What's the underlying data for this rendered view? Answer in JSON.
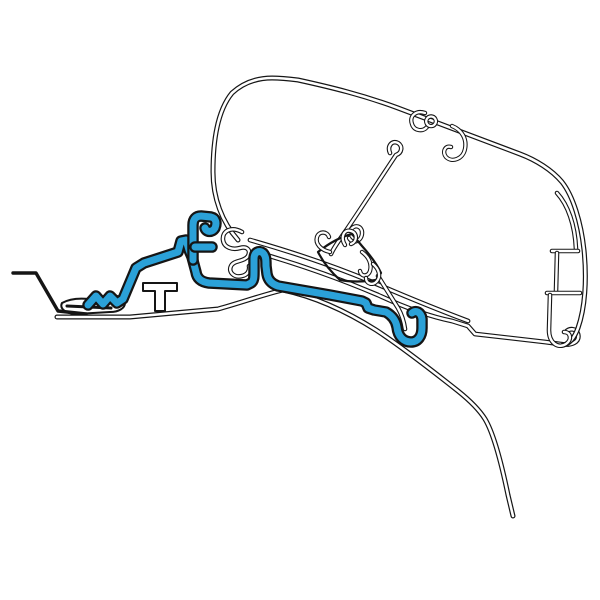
{
  "canvas": {
    "width": 600,
    "height": 600,
    "background": "#ffffff"
  },
  "colors": {
    "line": "#151515",
    "core": "#ffffff",
    "highlight": "#2ba1d8"
  },
  "drawing": {
    "viewbox": "0 0 600 600",
    "parts": [
      {
        "name": "van-gutter-edge",
        "type": "line",
        "outer": 3.4,
        "d": "M 13,273 L 36,273 L 58,311 L 86,314"
      },
      {
        "name": "van-roof-contour",
        "type": "tube",
        "outer": 5,
        "inner": 2.6,
        "d": "M 57,317 L 130,317 L 218,309 C 240,303 262,295 283,290 C 316,297 346,311 376,330 C 402,347 434,372 458,391 C 473,403 480,411 485,419 C 494,434 502,466 508,495 L 513,516"
      },
      {
        "name": "gutter-pad",
        "type": "fill",
        "outer": 2,
        "d": "M 62,303 C 69,299 79,298 89,299 L 110,296 C 119,295 125,298 125,303 C 125,308 119,312 110,312 L 76,314 C 67,314 59,309 62,303 Z"
      },
      {
        "name": "gutter-pad-edge",
        "type": "line",
        "outer": 3,
        "d": "M 67,306 L 111,308"
      },
      {
        "name": "t-bracket",
        "type": "fill",
        "outer": 2,
        "d": "M 143,283 L 177,283 L 177,291 L 165,291 L 165,311 L 155,311 L 155,291 L 143,291 Z"
      },
      {
        "name": "case-rail",
        "type": "tube",
        "outer": 4.8,
        "inner": 2.5,
        "d": "M 256,252 C 298,264 338,278 378,295 C 408,309 432,317 452,321 L 468,326 L 475,334 L 545,342 L 560,344 C 572,346 580,342 578,334 C 576,328 569,328 566,332"
      },
      {
        "name": "case-outline",
        "type": "tube",
        "outer": 5,
        "inner": 2.6,
        "d": "M 238,240 C 222,222 213,198 213,172 C 213,140 218,110 232,93 C 244,82 258,78 272,78 C 282,78 290,79 298,80 C 330,87 363,95 398,108 L 520,154 C 536,160 552,170 562,182 C 573,196 581,222 584,250 C 587,280 585,308 578,328 C 574,339 569,344 563,345"
      },
      {
        "name": "case-bottom-edge",
        "type": "tube",
        "outer": 4.8,
        "inner": 2.5,
        "d": "M 250,240 C 292,252 334,266 372,282 C 402,295 436,309 468,321"
      },
      {
        "name": "case-left-hooks",
        "type": "tube",
        "outer": 4.6,
        "inner": 2.4,
        "d": "M 242,232 C 231,226 222,231 223,240 C 224,248 233,250 240,248 C 247,246 251,250 248,256 C 244,262 234,260 231,266 C 228,272 234,278 242,276 C 247,275 250,271 249,266"
      },
      {
        "name": "rib-top",
        "type": "tube",
        "outer": 4.6,
        "inner": 2.4,
        "d": "M 557,193 C 568,205 575,225 576,249"
      },
      {
        "name": "rib-bar-upper",
        "type": "tube",
        "outer": 4.6,
        "inner": 2.4,
        "d": "M 552,251 L 578,251"
      },
      {
        "name": "rib-wall-upper",
        "type": "tube",
        "outer": 4.6,
        "inner": 2.4,
        "d": "M 557,253 L 556,291"
      },
      {
        "name": "rib-bar-lower",
        "type": "tube",
        "outer": 4.6,
        "inner": 2.4,
        "d": "M 547,293 L 580,293"
      },
      {
        "name": "rib-wall-lower",
        "type": "tube",
        "outer": 4.6,
        "inner": 2.4,
        "d": "M 550,295 L 549,330 C 549,343 558,349 566,344 C 572,340 571,332 564,332"
      },
      {
        "name": "top-hook-small",
        "type": "tube",
        "outer": 4.4,
        "inner": 2.3,
        "d": "M 425,113 C 416,110 409,116 412,124 C 414,131 423,132 427,127"
      },
      {
        "name": "top-hook-ring",
        "type": "tube",
        "outer": 4.4,
        "inner": 2.3,
        "d": "M 431,116.5 a 4.8,4.8 0 1 0 0.1,0"
      },
      {
        "name": "top-hook-large",
        "type": "tube",
        "outer": 4.4,
        "inner": 2.3,
        "d": "M 452,126 C 462,130 467,139 465,149 C 463,159 452,163 446,157 C 442,152 445,145 451,147"
      },
      {
        "name": "inner-strut",
        "type": "tube",
        "outer": 4.6,
        "inner": 2.4,
        "d": "M 390,153 C 387,146 392,140 398,143 C 403,146 402,153 396,155 C 380,179 362,207 347,229 C 340,239 334,247 331,254"
      },
      {
        "name": "inner-strut-hook",
        "type": "tube",
        "outer": 4.4,
        "inner": 2.3,
        "d": "M 350,231 C 354,223 363,226 362,234 C 361,242 352,244 349,238"
      },
      {
        "name": "rafter-bracket-leg",
        "type": "tube",
        "outer": 4.6,
        "inner": 2.4,
        "d": "M 378,276 L 398,308 C 402,315 404,322 405,329"
      },
      {
        "name": "rafter-bracket-body",
        "type": "fill",
        "outer": 2.2,
        "d": "M 318,252 C 328,244 340,237 352,234 L 362,246 C 370,255 377,264 381,273 L 376,280 C 364,282 350,282 340,280 C 331,272 323,262 318,252 Z"
      },
      {
        "name": "rafter-bracket-fork-left",
        "type": "tube",
        "outer": 4.4,
        "inner": 2.3,
        "d": "M 330,252 C 321,250 315,244 317,237 C 319,231 327,231 329,237"
      },
      {
        "name": "rafter-bracket-fork-right",
        "type": "tube",
        "outer": 4.4,
        "inner": 2.3,
        "d": "M 345,245 C 340,237 344,229 351,231 C 358,233 357,242 351,244"
      },
      {
        "name": "rafter-bracket-hook-upper",
        "type": "tube",
        "outer": 4.4,
        "inner": 2.3,
        "d": "M 362,252 C 369,257 372,264 370,271 C 368,277 361,277 360,271"
      },
      {
        "name": "rafter-bracket-hook-lower",
        "type": "tube",
        "outer": 4.4,
        "inner": 2.3,
        "d": "M 373,264 C 379,269 381,276 377,281 C 373,286 366,284 366,278"
      },
      {
        "name": "adapter-bracket-main",
        "type": "highlight",
        "outer": 11.5,
        "inner": 7,
        "d": "M 88,305 L 96,296 L 103,304 L 110,296 L 117,303 L 123,299 L 136,268 L 144,263 L 178,252 L 181,241 L 186,240 L 189,250 L 192,257 L 196,272 C 197,279 202,282 209,283 L 247,285 L 251,283 C 254,281 254,277 254,272 L 254,259 C 254,252 259,250 263,253 C 266,256 266,260 266,266 L 267,274 C 268,280 272,284 278,286 L 330,295 L 362,301 L 366,303 L 368,308 L 374,310 L 386,312 C 393,316 396,321 397,327 C 398,337 404,342 411,342 C 418,342 422,336 422,328 L 422,319 C 421,312 416,310 412,313"
      },
      {
        "name": "adapter-bracket-stem",
        "type": "highlight",
        "outer": 11.5,
        "inner": 7,
        "d": "M 193,260 L 193,225 C 193,219 196,216 201,216 L 211,217 C 216,218 217,223 215,228 C 212,233 206,232 205,228"
      },
      {
        "name": "adapter-bracket-arm",
        "type": "highlight",
        "outer": 11.5,
        "inner": 7,
        "d": "M 195,247 L 212,247"
      }
    ]
  }
}
